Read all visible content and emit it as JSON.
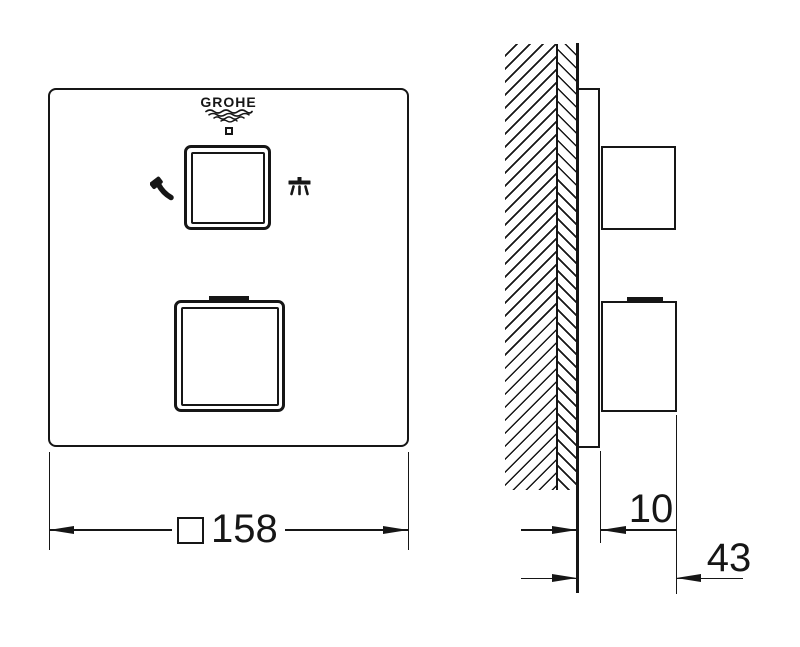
{
  "colors": {
    "ink": "#161616",
    "paper": "#ffffff"
  },
  "front_view": {
    "logo_text": "GROHE",
    "temperature_marking": "38",
    "width_dimension": {
      "square_symbol": "□",
      "value": "158"
    },
    "icon_left": "hand-shower",
    "icon_right": "head-shower"
  },
  "side_view": {
    "trim_depth_dimension": {
      "value": "10"
    },
    "handle_depth_dimension": {
      "value": "43"
    }
  }
}
